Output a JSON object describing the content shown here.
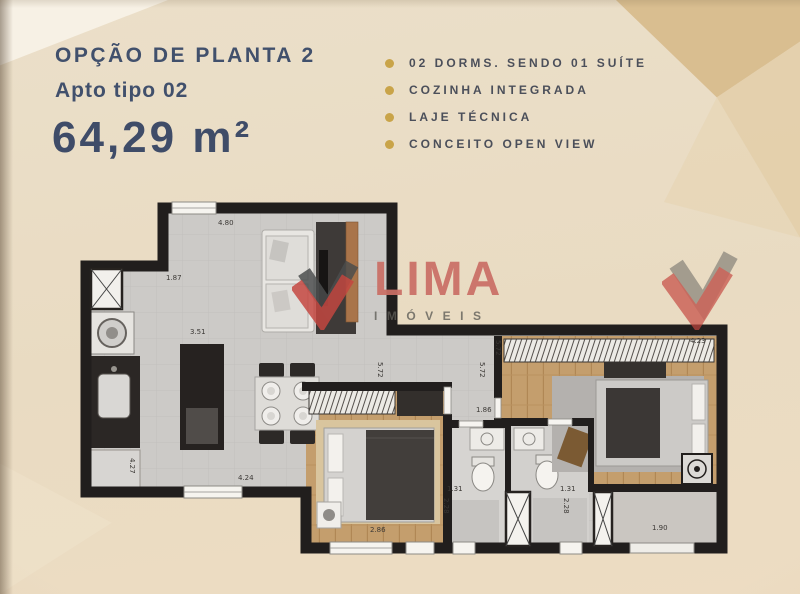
{
  "header": {
    "title": "OPÇÃO DE PLANTA 2",
    "subtitle": "Apto tipo 02",
    "area": "64,29 m²"
  },
  "features": {
    "items": [
      "02 DORMS. SENDO 01 SUÍTE",
      "COZINHA INTEGRADA",
      "LAJE TÉCNICA",
      "CONCEITO OPEN VIEW"
    ]
  },
  "watermark": {
    "name": "LIMA",
    "tagline": "IMÓVEIS"
  },
  "colors": {
    "title_text": "#41506c",
    "feature_text": "#4b4f5a",
    "bullet_gold": "#c9a449",
    "logo_red": "#ca6f66",
    "logo_icon_red": "#c4463f",
    "logo_icon_dark": "#4a4c4c",
    "wall_black": "#211e1d",
    "background_beige": "#e9dcc6",
    "accent_tan": "#d8bc8d",
    "wood_floor": "#c49e6d"
  },
  "floorplan": {
    "dimensions": [
      {
        "t": "4.80",
        "x": 218,
        "y": 219
      },
      {
        "t": "1.87",
        "x": 166,
        "y": 274
      },
      {
        "t": "3.51",
        "x": 190,
        "y": 328
      },
      {
        "t": "4.27",
        "x": 136,
        "y": 458,
        "v": true
      },
      {
        "t": "4.24",
        "x": 238,
        "y": 474
      },
      {
        "t": "2.86",
        "x": 370,
        "y": 526
      },
      {
        "t": "1.86",
        "x": 476,
        "y": 406
      },
      {
        "t": "1.31",
        "x": 447,
        "y": 485
      },
      {
        "t": "2.28",
        "x": 450,
        "y": 498,
        "v": true
      },
      {
        "t": "1.31",
        "x": 560,
        "y": 485
      },
      {
        "t": "2.28",
        "x": 570,
        "y": 498,
        "v": true
      },
      {
        "t": "1.90",
        "x": 652,
        "y": 524
      },
      {
        "t": "4.23",
        "x": 690,
        "y": 337
      },
      {
        "t": "5.72",
        "x": 502,
        "y": 340,
        "v": true
      },
      {
        "t": "5.72",
        "x": 384,
        "y": 362,
        "v": true
      },
      {
        "t": "5.72",
        "x": 486,
        "y": 362,
        "v": true
      }
    ]
  }
}
